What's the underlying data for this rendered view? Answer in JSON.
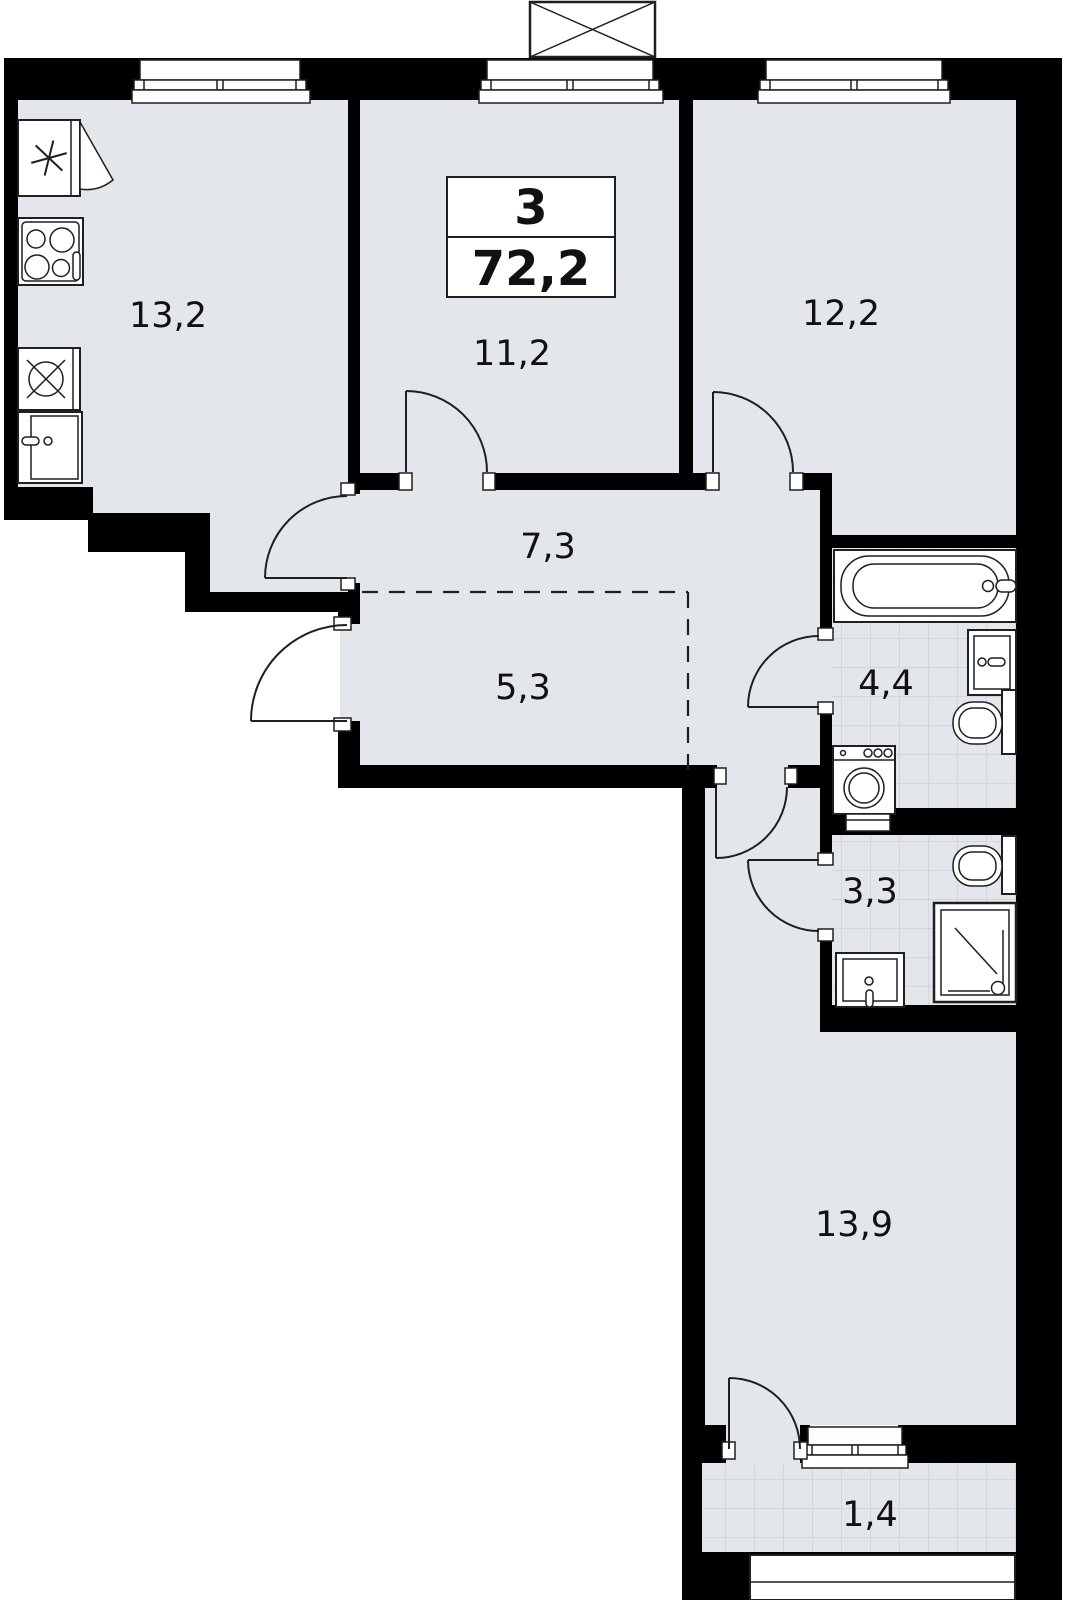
{
  "floorplan": {
    "unit": {
      "rooms_count": "3",
      "total_area": "72,2"
    },
    "rooms": [
      {
        "name": "kitchen",
        "area": "13,2"
      },
      {
        "name": "room-1",
        "area": "11,2"
      },
      {
        "name": "room-2",
        "area": "12,2"
      },
      {
        "name": "hallway",
        "area": "7,3"
      },
      {
        "name": "hallway-alcove",
        "area": "5,3"
      },
      {
        "name": "bathroom",
        "area": "4,4"
      },
      {
        "name": "shower-room",
        "area": "3,3"
      },
      {
        "name": "room-3",
        "area": "13,9"
      },
      {
        "name": "balcony",
        "area": "1,4"
      }
    ],
    "icons": [
      "refrigerator-icon",
      "stove-icon",
      "kitchen-sink-icon",
      "kitchen-cabinet-icon",
      "bathtub-icon",
      "washbasin-icon",
      "toilet-icon",
      "washing-machine-icon",
      "shower-icon",
      "ventilation-shaft-icon",
      "window-icon",
      "door-swing-icon"
    ],
    "colors": {
      "floor": "#e3e7eb",
      "wall": "#000000",
      "outline": "#1f1f1f",
      "tile_grid": "#c6ccd2",
      "background": "#ffffff"
    }
  }
}
